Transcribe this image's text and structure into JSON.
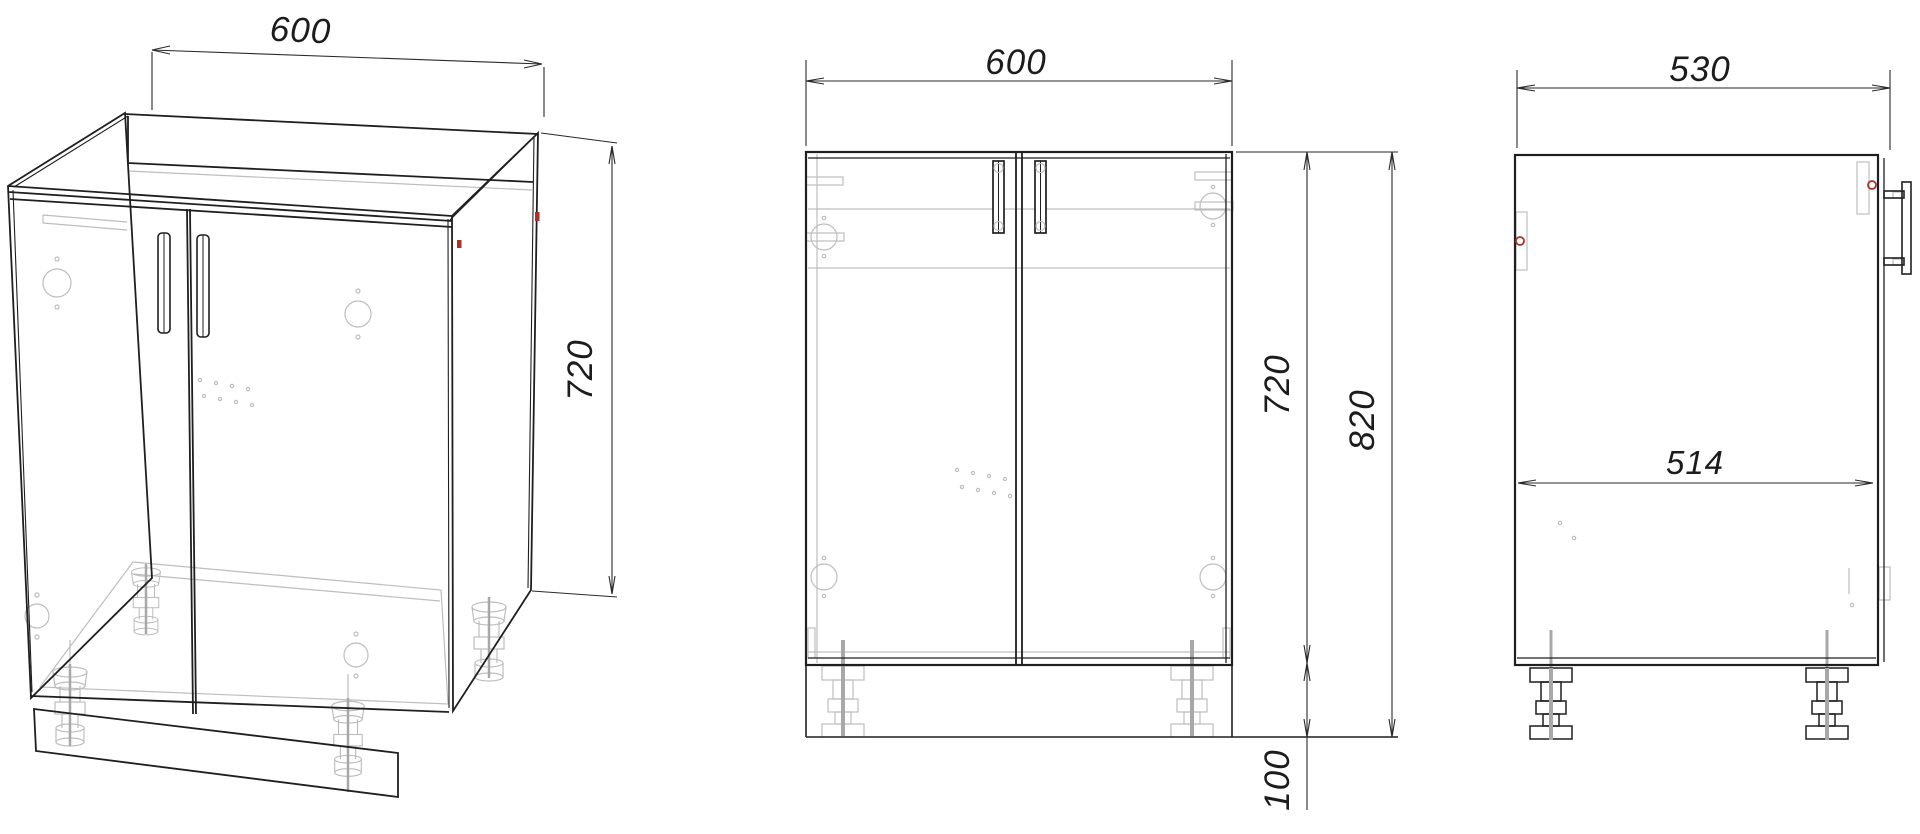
{
  "drawing": {
    "type": "furniture-technical-drawing",
    "views": {
      "isometric": {
        "dims": {
          "width": "600",
          "height": "720"
        }
      },
      "front": {
        "dims": {
          "width": "600",
          "body_height": "720",
          "total_height": "820",
          "leg_height": "100"
        }
      },
      "side": {
        "dims": {
          "depth": "530",
          "inner_depth": "514"
        }
      }
    },
    "colors": {
      "background": "#ffffff",
      "line": "#1f1f1f",
      "hidden_line": "#bdbdbd",
      "accent_red": "#a93226"
    }
  }
}
